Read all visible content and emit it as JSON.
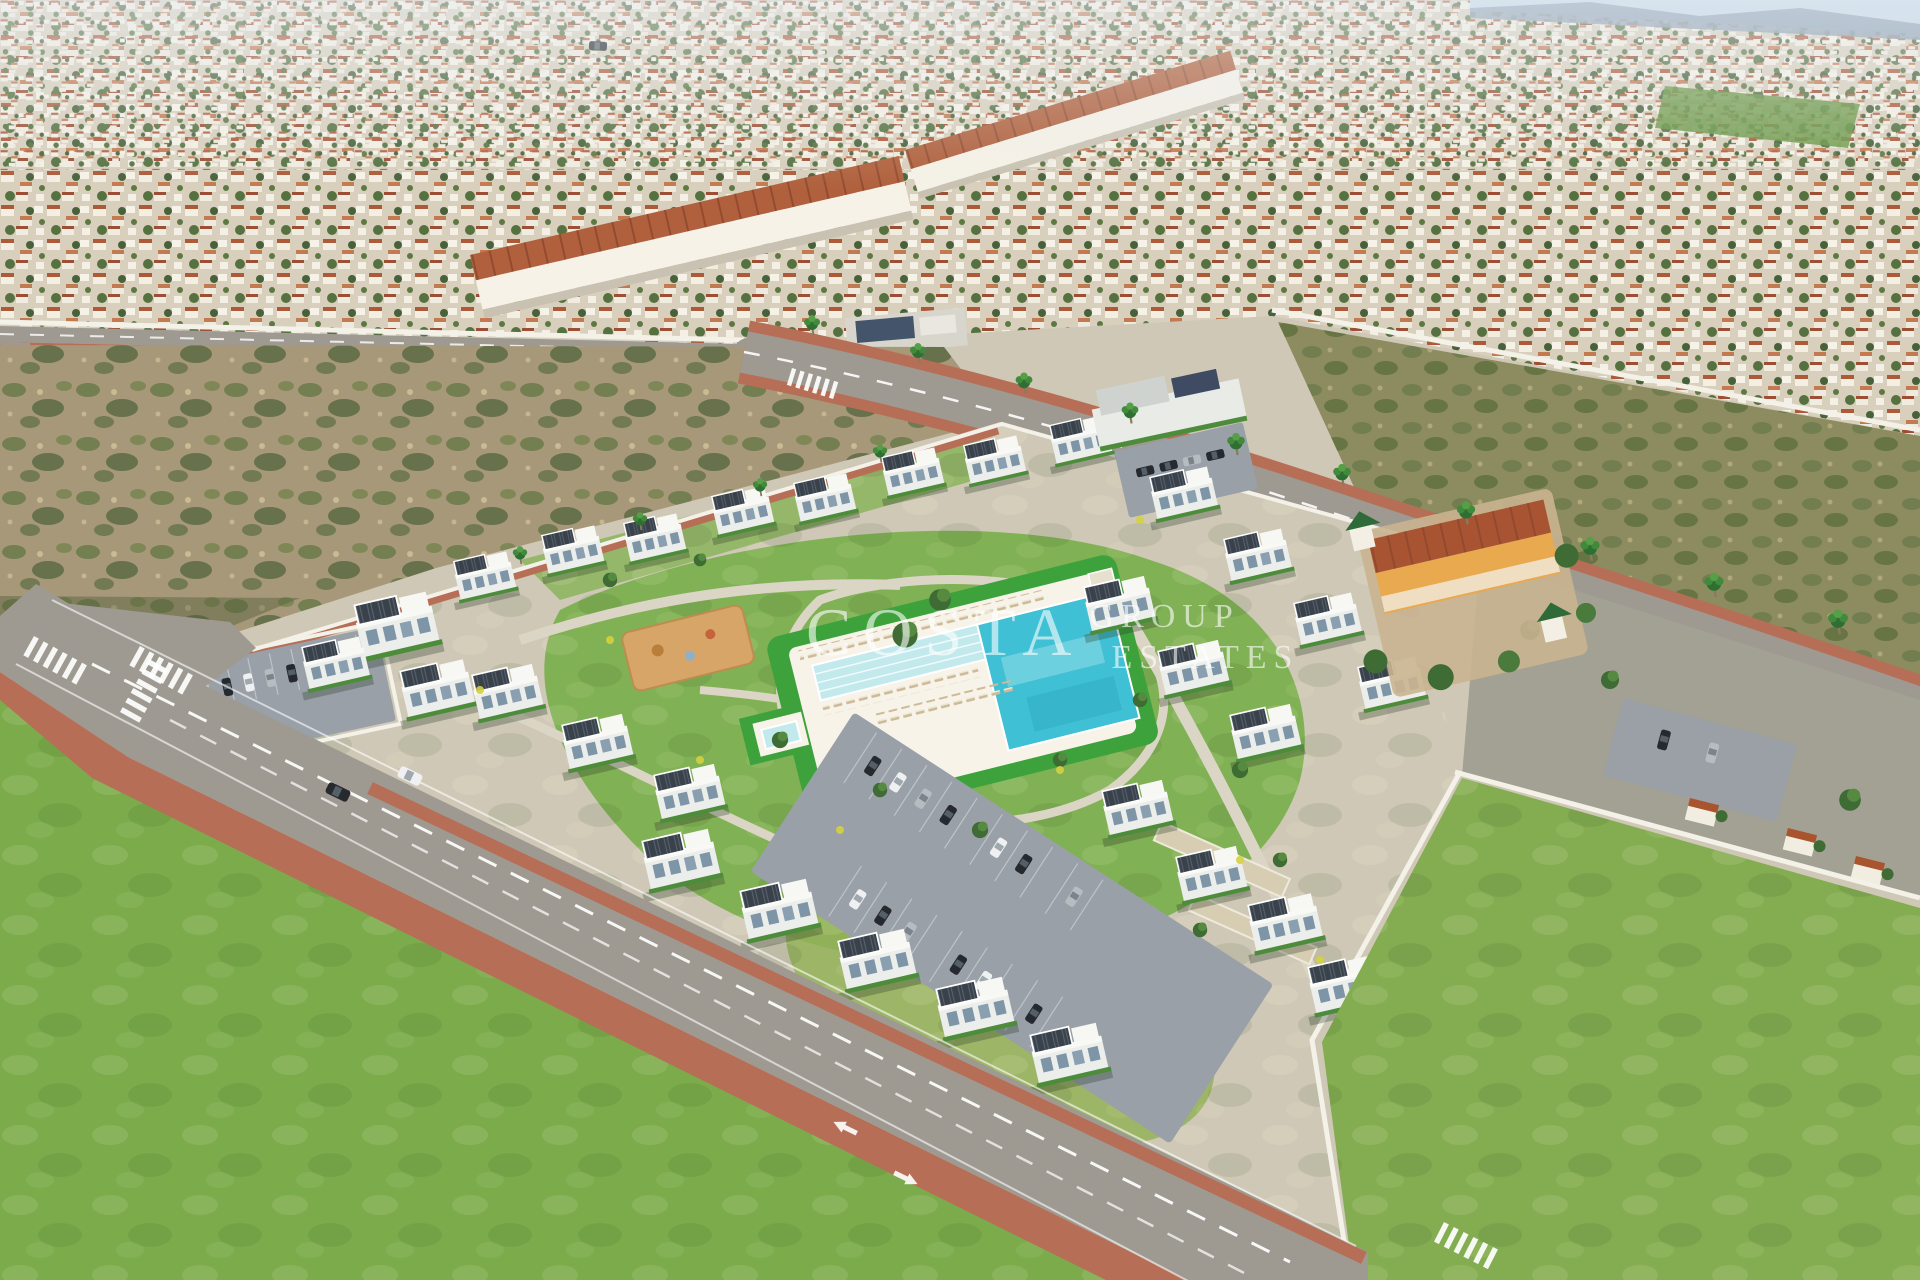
{
  "watermark": {
    "primary": "COSTA",
    "secondary_top": "GROUP",
    "secondary_bottom": "ESTATES"
  },
  "palette": {
    "sky": "#c3d8e8",
    "hills": "#8397aa",
    "town_base": "#d8cfbc",
    "town_roof": "#b0603c",
    "town_house": "#f4f0e5",
    "town_tree": "#4a6637",
    "dirt_field": "#a69878",
    "scrub_olive": "#8d8b60",
    "road_asphalt": "#9e9a92",
    "sidewalk_red": "#b76e56",
    "road_marking": "#ffffff",
    "parcel_ground": "#cfc8b6",
    "path_light": "#dbd5c6",
    "amenity_lawn": "#7cb050",
    "pool_lawn": "#3da23c",
    "pool_deep": "#3fc0d4",
    "pool_shallow": "#c2eaed",
    "deck_white": "#f7f3e9",
    "lounger_tan": "#c8b794",
    "building_white": "#eceeeb",
    "solar_panel": "#39414a",
    "hedge_green": "#4c8c3b",
    "window_glass": "#7d95a6",
    "lot_gray": "#99a0a8",
    "car_dark": "#26292e",
    "car_white": "#eef0f1",
    "car_silver": "#b7bcc0",
    "car_red": "#b23227",
    "lawn_bottom_left": "#7cab4c",
    "lawn_bottom_right": "#84ad52",
    "wall_white": "#f3f1e8",
    "orange_wall": "#e8a94f",
    "orange_roof": "#a85432",
    "tree_green": "#3f6b34"
  }
}
